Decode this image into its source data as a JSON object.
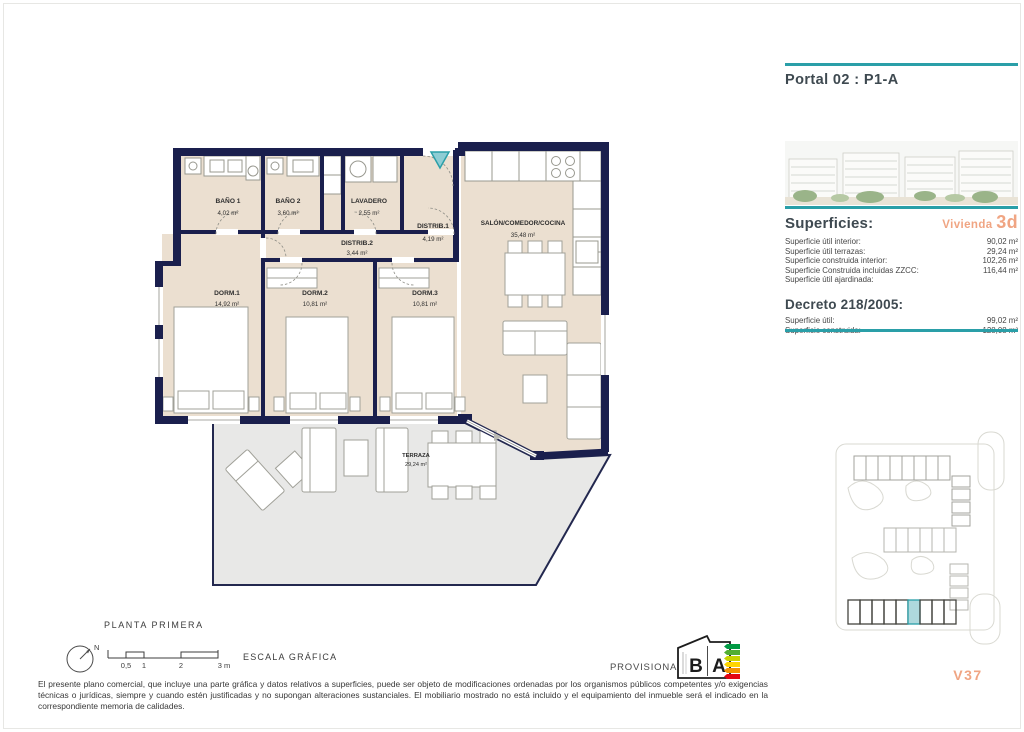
{
  "header": {
    "title": "Portal 02 : P1-A"
  },
  "panel": {
    "superficies_heading": "Superficies:",
    "vivienda_label": "Vivienda",
    "vivienda_value": "3d",
    "superficies_rows": [
      {
        "label": "Superficie útil interior:",
        "value": "90,02 m²"
      },
      {
        "label": "Superficie útil terrazas:",
        "value": "29,24 m²"
      },
      {
        "label": "Superficie construida interior:",
        "value": "102,26 m²"
      },
      {
        "label": "Superficie Construida incluidas ZZCC:",
        "value": "116,44 m²"
      },
      {
        "label": "Superficie útil ajardinada:",
        "value": ""
      }
    ],
    "decreto_heading": "Decreto 218/2005:",
    "decreto_rows": [
      {
        "label": "Superficie útil:",
        "value": "99,02 m²"
      },
      {
        "label": "Superficie construida:",
        "value": "128,08 m²"
      }
    ],
    "unit_code": "V37"
  },
  "plan": {
    "floor_label": "PLANTA PRIMERA",
    "rooms": {
      "bano1": {
        "name": "BAÑO 1",
        "area": "4,02 m²"
      },
      "bano2": {
        "name": "BAÑO 2",
        "area": "3,60 m²"
      },
      "lavadero": {
        "name": "LAVADERO",
        "area": "2,55 m²"
      },
      "distrib1": {
        "name": "DISTRIB.1",
        "area": "4,19 m²"
      },
      "distrib2": {
        "name": "DISTRIB.2",
        "area": "3,44 m²"
      },
      "dorm1": {
        "name": "DORM.1",
        "area": "14,92 m²"
      },
      "dorm2": {
        "name": "DORM.2",
        "area": "10,81 m²"
      },
      "dorm3": {
        "name": "DORM.3",
        "area": "10,81 m²"
      },
      "salon": {
        "name": "SALÓN/COMEDOR/COCINA",
        "area": "35,48 m²"
      },
      "terraza": {
        "name": "TERRAZA",
        "area": "29,24 m²"
      }
    }
  },
  "scalebar": {
    "north": "N",
    "tick1": "0,5",
    "tick2": "1",
    "tick3": "2",
    "tick4": "3 m",
    "label": "ESCALA GRÁFICA"
  },
  "footer": {
    "provisional": "PROVISIONAL",
    "disclaimer": "El presente plano comercial, que incluye una parte gráfica y datos relativos a superficies, puede ser objeto de modificaciones ordenadas por los organismos públicos competentes y/o exigencias técnicas o jurídicas, siempre y cuando estén justificadas y no supongan alteraciones sustanciales. El mobiliario mostrado no está incluido y el equipamiento del inmueble será el indicado en la correspondiente memoria de calidades."
  },
  "energy_label": {
    "letter_left": "B",
    "letter_right": "A"
  },
  "colors": {
    "teal": "#2a9fa8",
    "teal_light": "#8ecdd4",
    "accent_orange": "#f0a583",
    "wall_navy": "#1a1f4d",
    "floor_beige": "#ebdfd0",
    "terrace_gray": "#e8e8e7",
    "siteplan_highlight": "#aed9dd"
  }
}
